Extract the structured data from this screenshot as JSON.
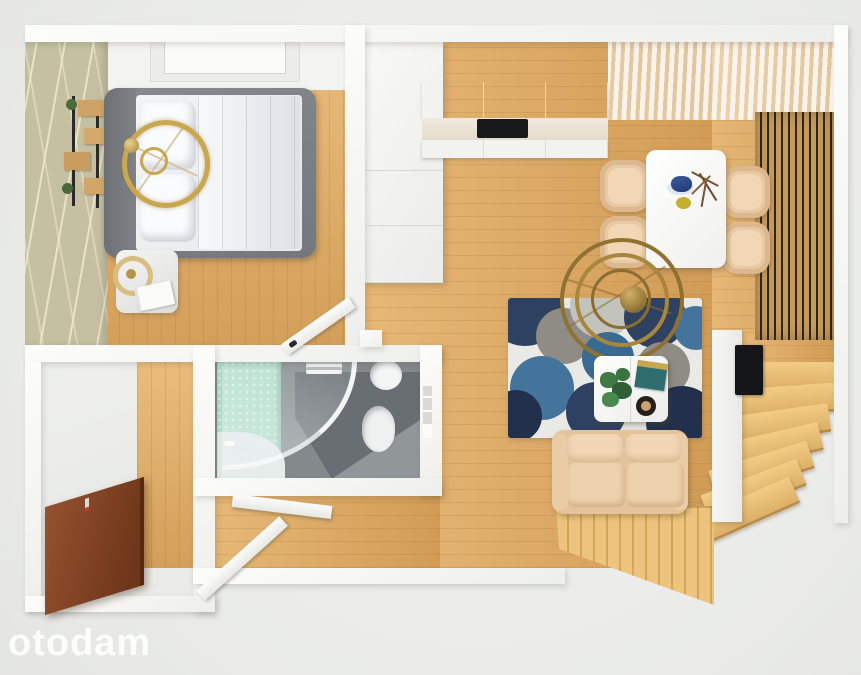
{
  "watermark": {
    "text": "otodam"
  },
  "scene": {
    "type": "3d-apartment-floor-plan-top-view",
    "rooms": [
      "bedroom",
      "bathroom",
      "kitchen",
      "dining-area",
      "living-area",
      "hallway",
      "staircase"
    ]
  },
  "palette": {
    "background": "#edeeec",
    "wall_white": "#f7f7f5",
    "floor_wood": "#e2ad64",
    "floor_wood_dark": "#d09a52",
    "wallpaper_olive": "#c6c0a3",
    "wallpaper_wave_cream": "#eae3c5",
    "bed_gray": "#7f8387",
    "bedding_white": "#f1f2f4",
    "gold_brass": "#c09c4a",
    "sofa_beige": "#e9cba6",
    "rug_navy": "#2f4161",
    "rug_blue": "#44749c",
    "rug_gray": "#8e8c85",
    "mint_shower": "#b2e0cd",
    "tile_gray": "#70767a",
    "stair_wood": "#ecc27b",
    "slat_wood": "#c0914f",
    "entry_door_brown": "#8e4d2b",
    "tv_black": "#141618",
    "mug_blue": "#2c4a88",
    "dish_yellow": "#c3b02c",
    "plant_green": "#3f7a43"
  }
}
